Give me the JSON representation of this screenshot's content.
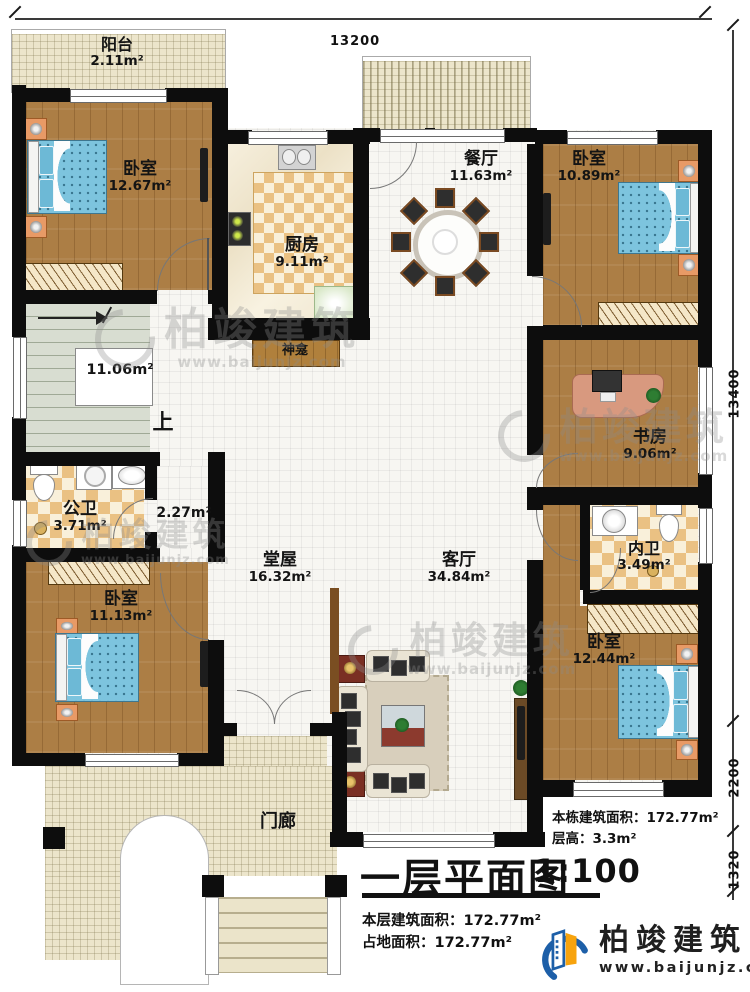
{
  "dimensions": {
    "top": "13200",
    "right_main": "13400",
    "right_mid": "2200",
    "right_bottom": "1320"
  },
  "rooms": {
    "balcony": {
      "name": "阳台",
      "area": "2.11m²"
    },
    "bedroom1": {
      "name": "卧室",
      "area": "12.67m²"
    },
    "kitchen": {
      "name": "厨房",
      "area": "9.11m²"
    },
    "dining": {
      "name": "餐厅",
      "area": "11.63m²"
    },
    "bedroom2": {
      "name": "卧室",
      "area": "10.89m²"
    },
    "study": {
      "name": "书房",
      "area": "9.06m²"
    },
    "bath_inner": {
      "name": "内卫",
      "area": "3.49m²"
    },
    "bedroom3": {
      "name": "卧室",
      "area": "12.44m²"
    },
    "living": {
      "name": "客厅",
      "area": "34.84m²"
    },
    "hall": {
      "name": "堂屋",
      "area": "16.32m²"
    },
    "bath_public": {
      "name": "公卫",
      "area": "3.71m²"
    },
    "bedroom4": {
      "name": "卧室",
      "area": "11.13m²"
    },
    "porch": {
      "name": "门廊"
    },
    "shrine": {
      "name": "神龛"
    },
    "stairs": {
      "area": "11.06m²",
      "up": "上"
    },
    "corridor": {
      "area": "2.27m²"
    }
  },
  "notes": {
    "right": [
      {
        "label": "本栋建筑面积：",
        "value": "172.77m²"
      },
      {
        "label": "层高：",
        "value": "3.3m²"
      }
    ],
    "left": [
      {
        "label": "本层建筑面积：",
        "value": "172.77m²"
      },
      {
        "label": "占地面积：",
        "value": "172.77m²"
      }
    ]
  },
  "title": {
    "text": "一层平面图",
    "scale": "1:100"
  },
  "logo": {
    "name": "柏竣建筑",
    "url": "www.baijunjz.com"
  },
  "watermark": {
    "name": "柏竣建筑",
    "url": "www.baijunjz.com"
  },
  "colors": {
    "wall": "#0d0d0d",
    "wood": "#ac7e45",
    "bed_blue": "#7dc4de",
    "logo_blue": "#1d5fa8",
    "logo_orange": "#f7a30d"
  }
}
